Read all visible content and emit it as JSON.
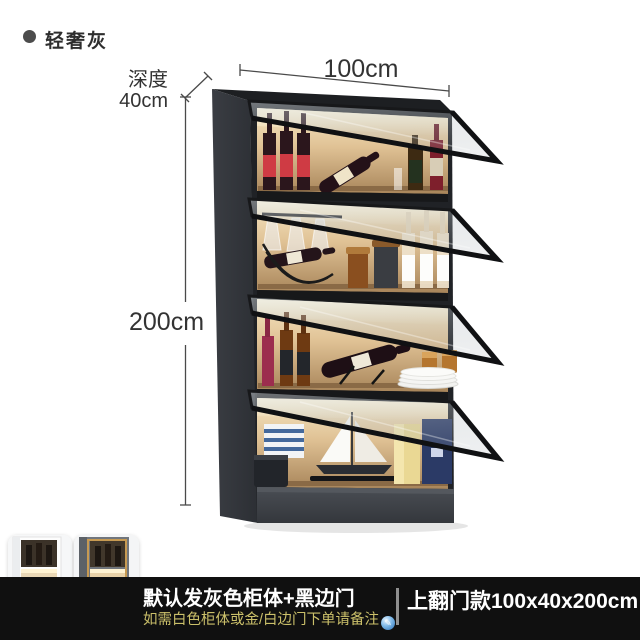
{
  "header": {
    "label": "轻奢灰",
    "bullet_color": "#4c4c4c"
  },
  "dimensions": {
    "width": "100cm",
    "depth_label": "深度",
    "depth_value": "40cm",
    "height": "200cm",
    "line_color": "#4a4a4a"
  },
  "product": {
    "cabinet": {
      "body_color": "#3c4046",
      "door_frame_color": "#17181a",
      "interior_light_color": "#e7cf9f",
      "door_style": "flip-up glass doors, open",
      "compartments": [
        {
          "name": "compartment-1",
          "contents": "red wine bottles, tilted display bottle, whisky bottles"
        },
        {
          "name": "compartment-2",
          "contents": "hanging stemware, wire bottle basket, canisters, white wine bottles"
        },
        {
          "name": "compartment-3",
          "contents": "liquor bottles, wine bottle on stand, whisky glasses, plate stack"
        },
        {
          "name": "compartment-4",
          "contents": "striped storage box, model sailboat, yellow gift box, navy gift box"
        }
      ]
    }
  },
  "variants": {
    "thumbnails": [
      {
        "name": "white-cabinet"
      },
      {
        "name": "gray-cabinet-gold-trim"
      }
    ]
  },
  "footer": {
    "bg_color": "#101010",
    "default_text": "默认发灰色柜体+黑边门",
    "note_text": "如需白色柜体或金/白边门下单请备注",
    "note_icon": "note-emoji-icon",
    "note_color": "#cbc06a",
    "divider_color": "#8f8f8f",
    "size_text": "上翻门款100x40x200cm",
    "size_text_color": "#ffffff"
  }
}
